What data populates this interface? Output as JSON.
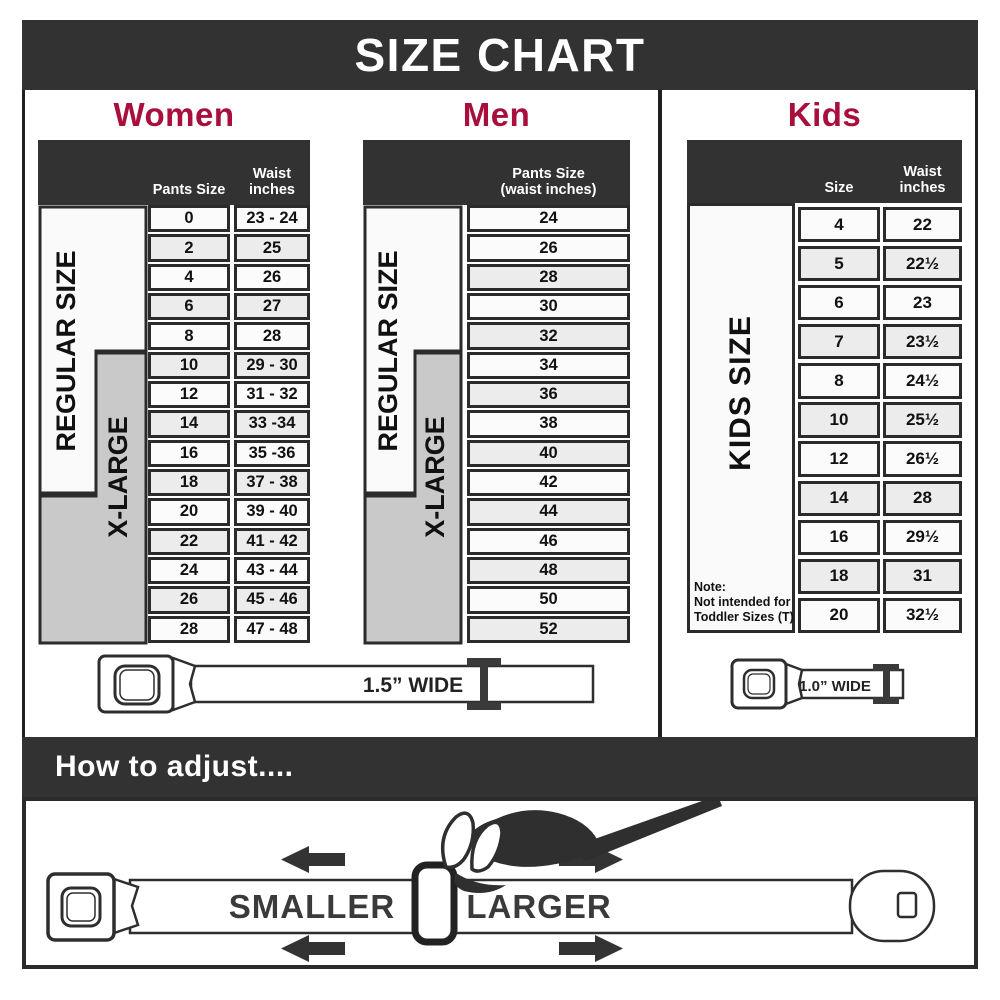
{
  "title": "SIZE CHART",
  "colors": {
    "accent_red": "#A80F3C",
    "header_dark": "#323232",
    "row_light": "#FBFBFB",
    "row_shaded": "#ECECEC",
    "xlarge_gray": "#C9C9C9"
  },
  "women": {
    "heading": "Women",
    "pants_header": "Pants Size",
    "waist_header_line1": "Waist",
    "waist_header_line2": "inches",
    "regular_label": "REGULAR SIZE",
    "xlarge_label": "X-LARGE",
    "rows": [
      {
        "size": "0",
        "waist": "23 - 24"
      },
      {
        "size": "2",
        "waist": "25"
      },
      {
        "size": "4",
        "waist": "26"
      },
      {
        "size": "6",
        "waist": "27"
      },
      {
        "size": "8",
        "waist": "28"
      },
      {
        "size": "10",
        "waist": "29 - 30"
      },
      {
        "size": "12",
        "waist": "31 - 32"
      },
      {
        "size": "14",
        "waist": "33 -34"
      },
      {
        "size": "16",
        "waist": "35 -36"
      },
      {
        "size": "18",
        "waist": "37 - 38"
      },
      {
        "size": "20",
        "waist": "39 - 40"
      },
      {
        "size": "22",
        "waist": "41 - 42"
      },
      {
        "size": "24",
        "waist": "43 - 44"
      },
      {
        "size": "26",
        "waist": "45 - 46"
      },
      {
        "size": "28",
        "waist": "47 - 48"
      }
    ]
  },
  "men": {
    "heading": "Men",
    "header_line1": "Pants Size",
    "header_line2": "(waist inches)",
    "regular_label": "REGULAR SIZE",
    "xlarge_label": "X-LARGE",
    "sizes": [
      "24",
      "26",
      "28",
      "30",
      "32",
      "34",
      "36",
      "38",
      "40",
      "42",
      "44",
      "46",
      "48",
      "50",
      "52"
    ]
  },
  "kids": {
    "heading": "Kids",
    "size_header": "Size",
    "waist_header_line1": "Waist",
    "waist_header_line2": "inches",
    "side_label": "KIDS SIZE",
    "note_line1": "Note:",
    "note_line2": "Not intended for",
    "note_line3": "Toddler Sizes (T)",
    "rows": [
      {
        "size": "4",
        "waist": "22"
      },
      {
        "size": "5",
        "waist": "22½"
      },
      {
        "size": "6",
        "waist": "23"
      },
      {
        "size": "7",
        "waist": "23½"
      },
      {
        "size": "8",
        "waist": "24½"
      },
      {
        "size": "10",
        "waist": "25½"
      },
      {
        "size": "12",
        "waist": "26½"
      },
      {
        "size": "14",
        "waist": "28"
      },
      {
        "size": "16",
        "waist": "29½"
      },
      {
        "size": "18",
        "waist": "31"
      },
      {
        "size": "20",
        "waist": "32½"
      }
    ]
  },
  "belts": {
    "adult_width": "1.5” WIDE",
    "kids_width": "1.0” WIDE"
  },
  "adjust": {
    "heading": "How to adjust....",
    "smaller": "SMALLER",
    "larger": "LARGER"
  }
}
